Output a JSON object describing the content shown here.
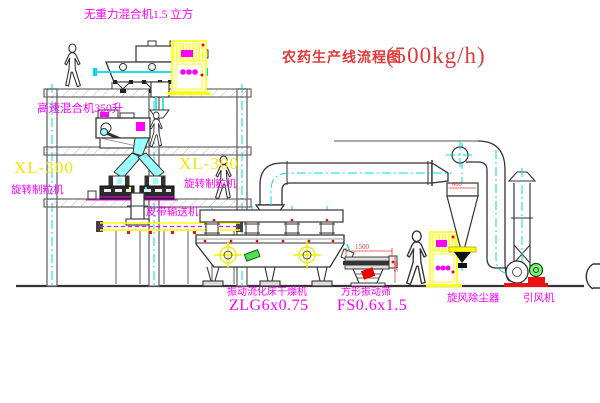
{
  "title": {
    "text": "农药生产线流程图",
    "capacity": "(500kg/h)"
  },
  "labels": {
    "gravity_mixer": "无重力混合机1.5 立方",
    "high_speed_mixer": "高速混合机350升",
    "granulator_left_model": "XL-300",
    "granulator_left_name": "旋转制粒机",
    "granulator_right_model": "XL-300",
    "granulator_right_name": "旋转制粒机",
    "belt_conveyor": "皮带输送机",
    "dryer_name": "振动流化床干燥机",
    "dryer_model": "ZLG6x0.75",
    "screen_name": "方形振动筛",
    "screen_model": "FS0.6x1.5",
    "cyclone": "旋风除尘器",
    "fan": "引风机"
  },
  "dimensions": {
    "cyclone_width": "600",
    "screen_length": "1500",
    "screen_height": "500"
  },
  "colors": {
    "label_magenta": "#ff00ff",
    "model_yellow": "#f5e400",
    "title_red": "#e03a3a",
    "centerline_cyan": "#00dddd",
    "cabinet_yellow": "#ffff00"
  }
}
